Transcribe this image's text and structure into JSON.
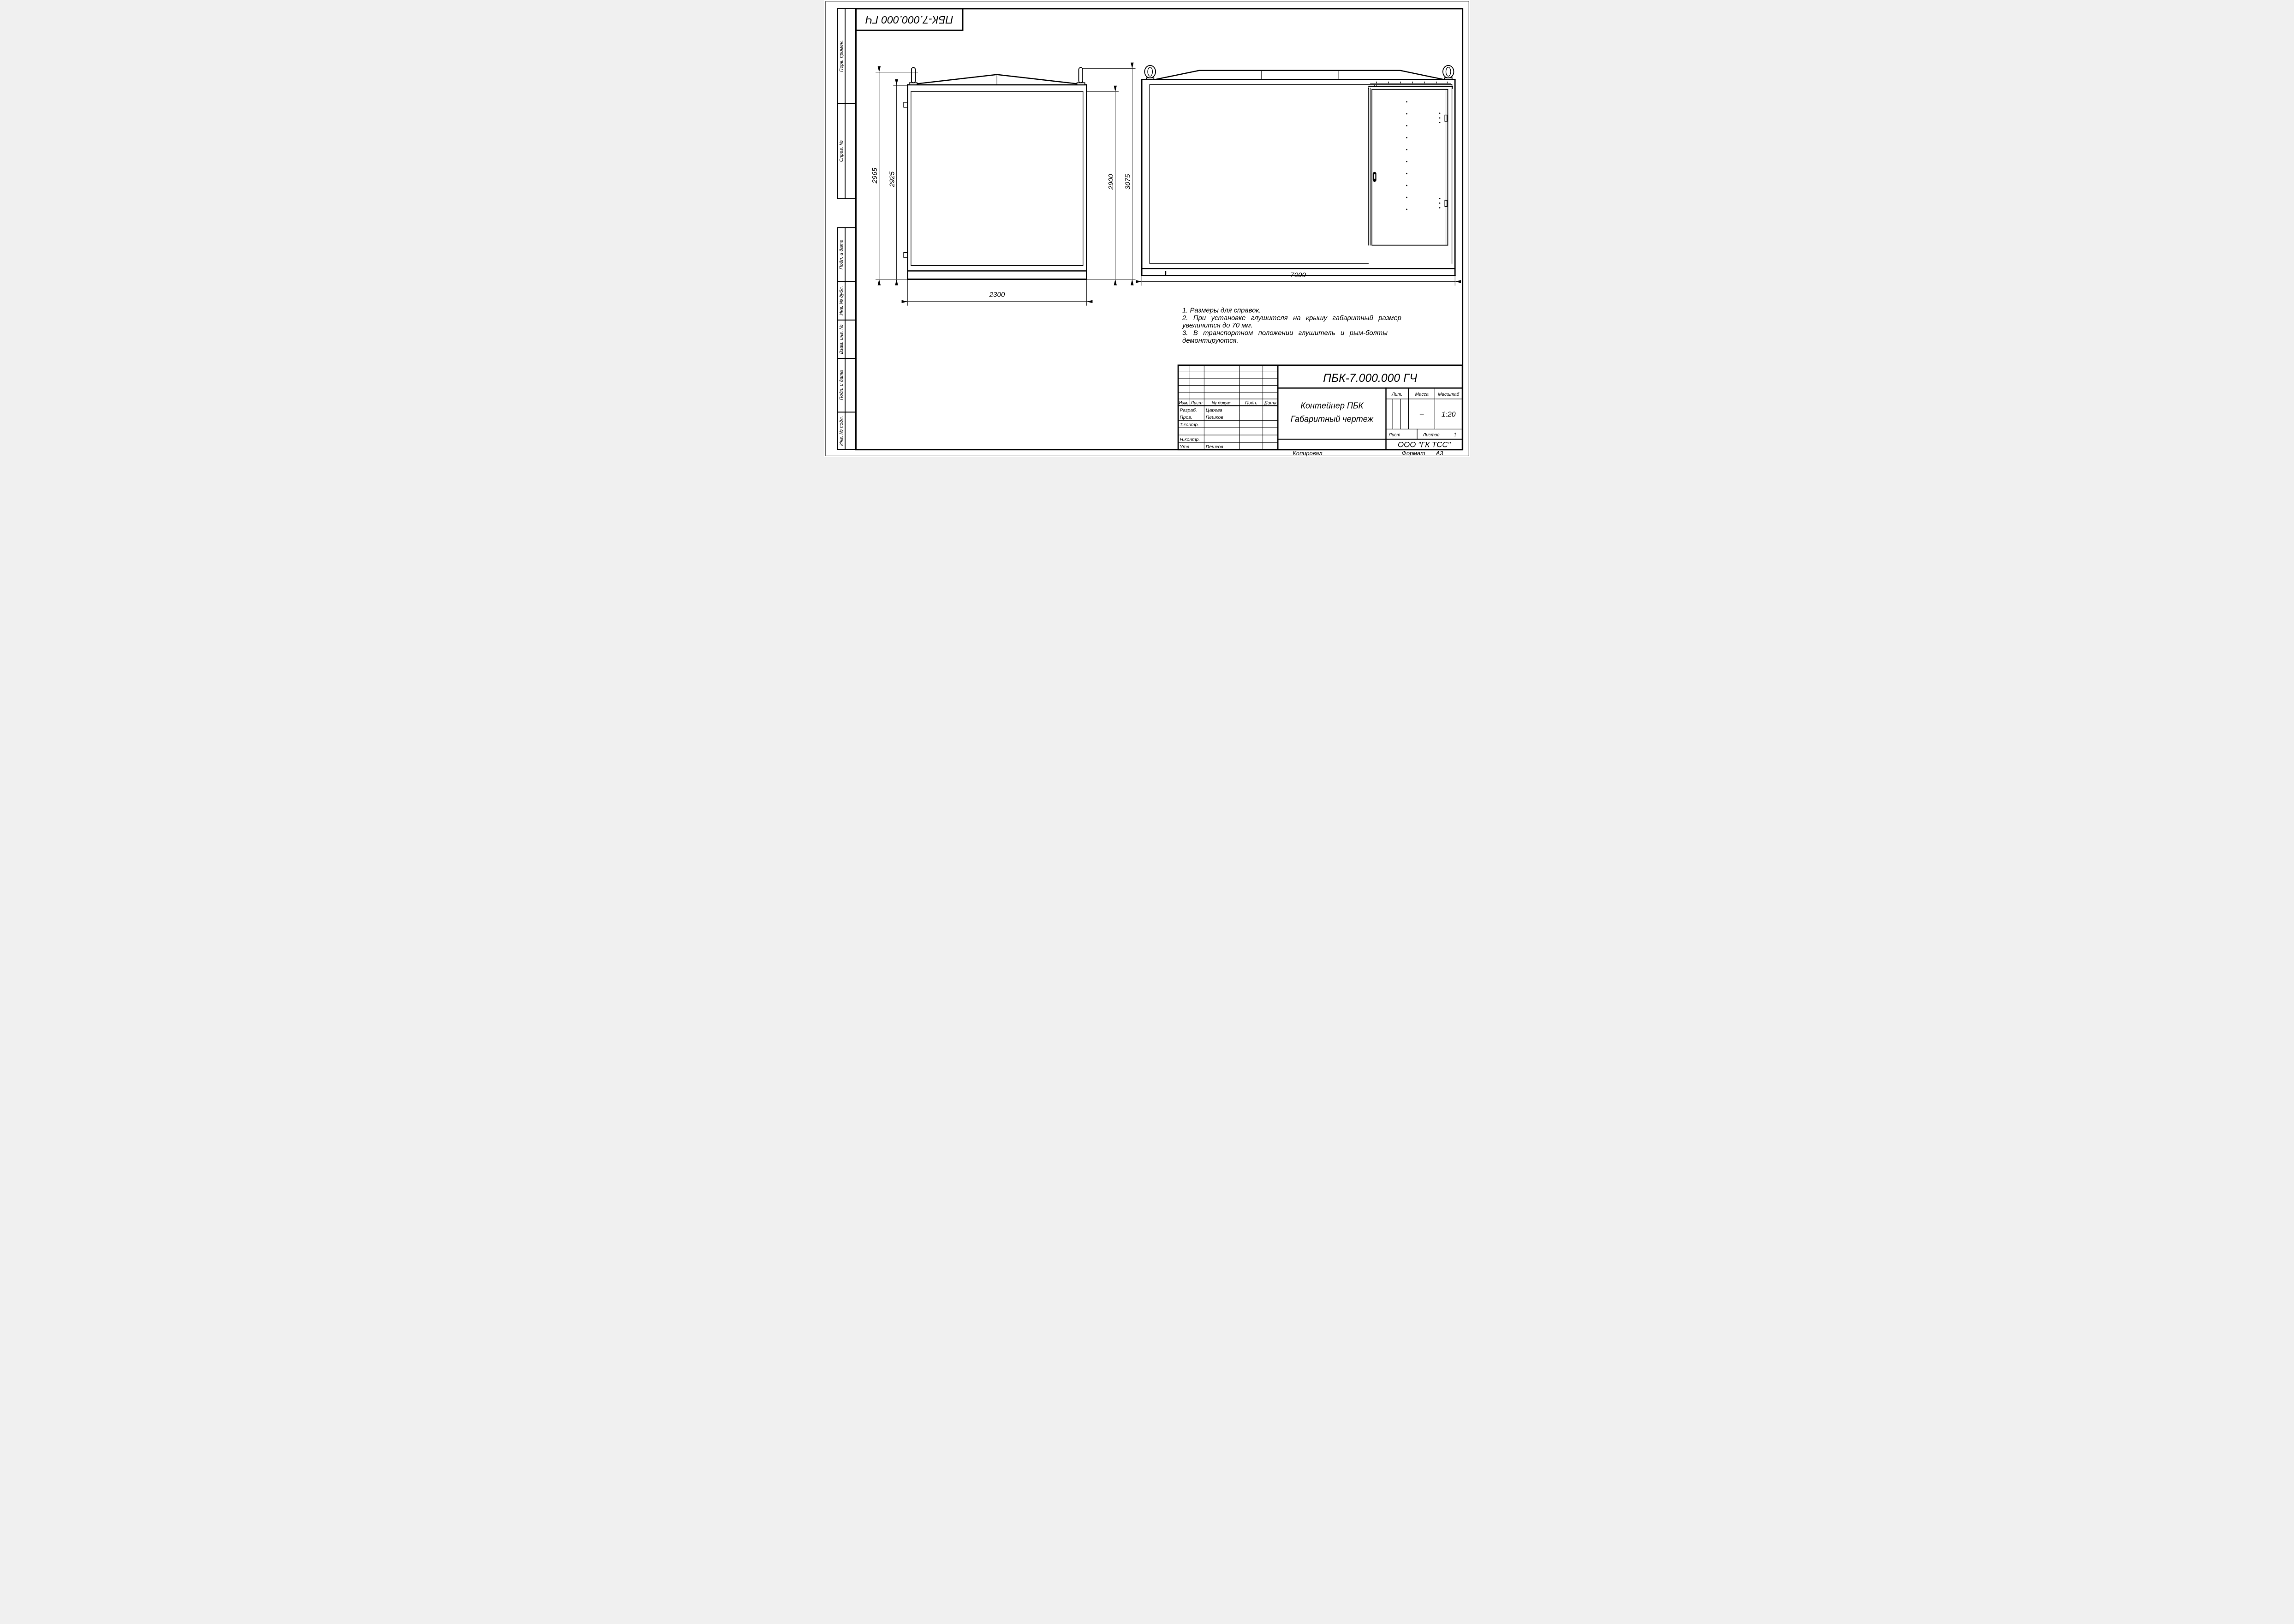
{
  "stamp": {
    "doc_number_top": "ПБК-7.000.000 ГЧ"
  },
  "margin_boxes": {
    "b1": "Перв. примен.",
    "b2": "Справ. №",
    "b3": "Подп. и дата",
    "b4": "Инв. № дубл.",
    "b5": "Взам. инв. №",
    "b6": "Подп. и дата",
    "b7": "Инв. № подл."
  },
  "end_view": {
    "dim_left_outer": "2965",
    "dim_left_inner": "2925",
    "dim_right_inner": "2900",
    "dim_right_outer": "3075",
    "dim_width": "2300"
  },
  "side_view": {
    "dim_length": "7000"
  },
  "notes": {
    "line1": "1. Размеры для справок.",
    "line2": "2. При  установке  глушителя  на  крышу  габаритный  размер",
    "line3": "увеличится до 70 мм.",
    "line4": "3. В  транспортном  положении  глушитель  и  рым-болты",
    "line5": "демонтируются."
  },
  "title_block": {
    "doc_number": "ПБК-7.000.000 ГЧ",
    "name_line1": "Контейнер ПБК",
    "name_line2": "Габаритный чертеж",
    "company": "ООО \"ГК ТСС\"",
    "cols": {
      "izm": "Изм.",
      "list": "Лист",
      "doc": "№ докум.",
      "podp": "Подп.",
      "data": "Дата"
    },
    "rows": {
      "r1_label": "Разраб.",
      "r1_name": "Царева",
      "r2_label": "Пров.",
      "r2_name": "Пешков",
      "r3_label": "Т.контр.",
      "r4_label": "Н.контр.",
      "r5_label": "Утв.",
      "r5_name": "Пешков"
    },
    "props": {
      "lit": "Лит.",
      "massa": "Масса",
      "masshtab": "Масштаб",
      "massa_value": "–",
      "masshtab_value": "1:20",
      "list": "Лист",
      "listov": "Листов",
      "listov_value": "1"
    }
  },
  "footer": {
    "copied": "Копировал",
    "format_label": "Формат",
    "format_value": "А3"
  }
}
